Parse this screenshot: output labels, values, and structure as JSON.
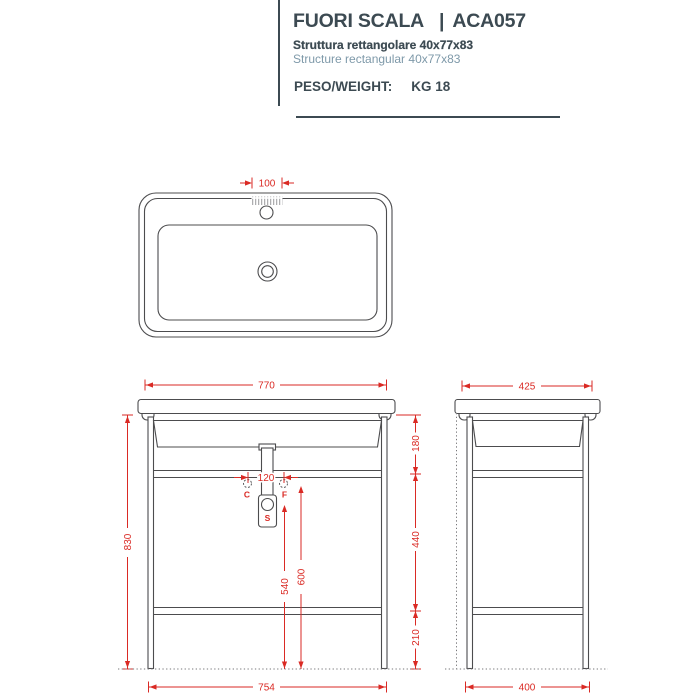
{
  "header": {
    "title_left": "FUORI SCALA",
    "separator": "|",
    "title_right": "ACA057",
    "subtitle_it": "Struttura rettangolare 40x77x83",
    "subtitle_en": "Structure rectangular 40x77x83",
    "weight_label": "PESO/WEIGHT:",
    "weight_value": "KG 18"
  },
  "dims": {
    "top": {
      "faucet_zone_width": "100"
    },
    "front": {
      "width_top": "770",
      "height_total": "830",
      "upper_section": "180",
      "mid_section": "440",
      "lower_section": "210",
      "hole_spacing": "120",
      "siphon_height": "540",
      "supply_height": "600",
      "width_bottom": "754"
    },
    "side": {
      "depth_top": "425",
      "depth_bottom": "400"
    }
  },
  "labels": {
    "cold": "C",
    "hot": "F",
    "siphon": "S"
  },
  "colors": {
    "dimension_red": "#da2a24",
    "ink": "#3c4a52",
    "muted_blue": "#7e99a9",
    "line_gray": "#4c4c4e"
  }
}
